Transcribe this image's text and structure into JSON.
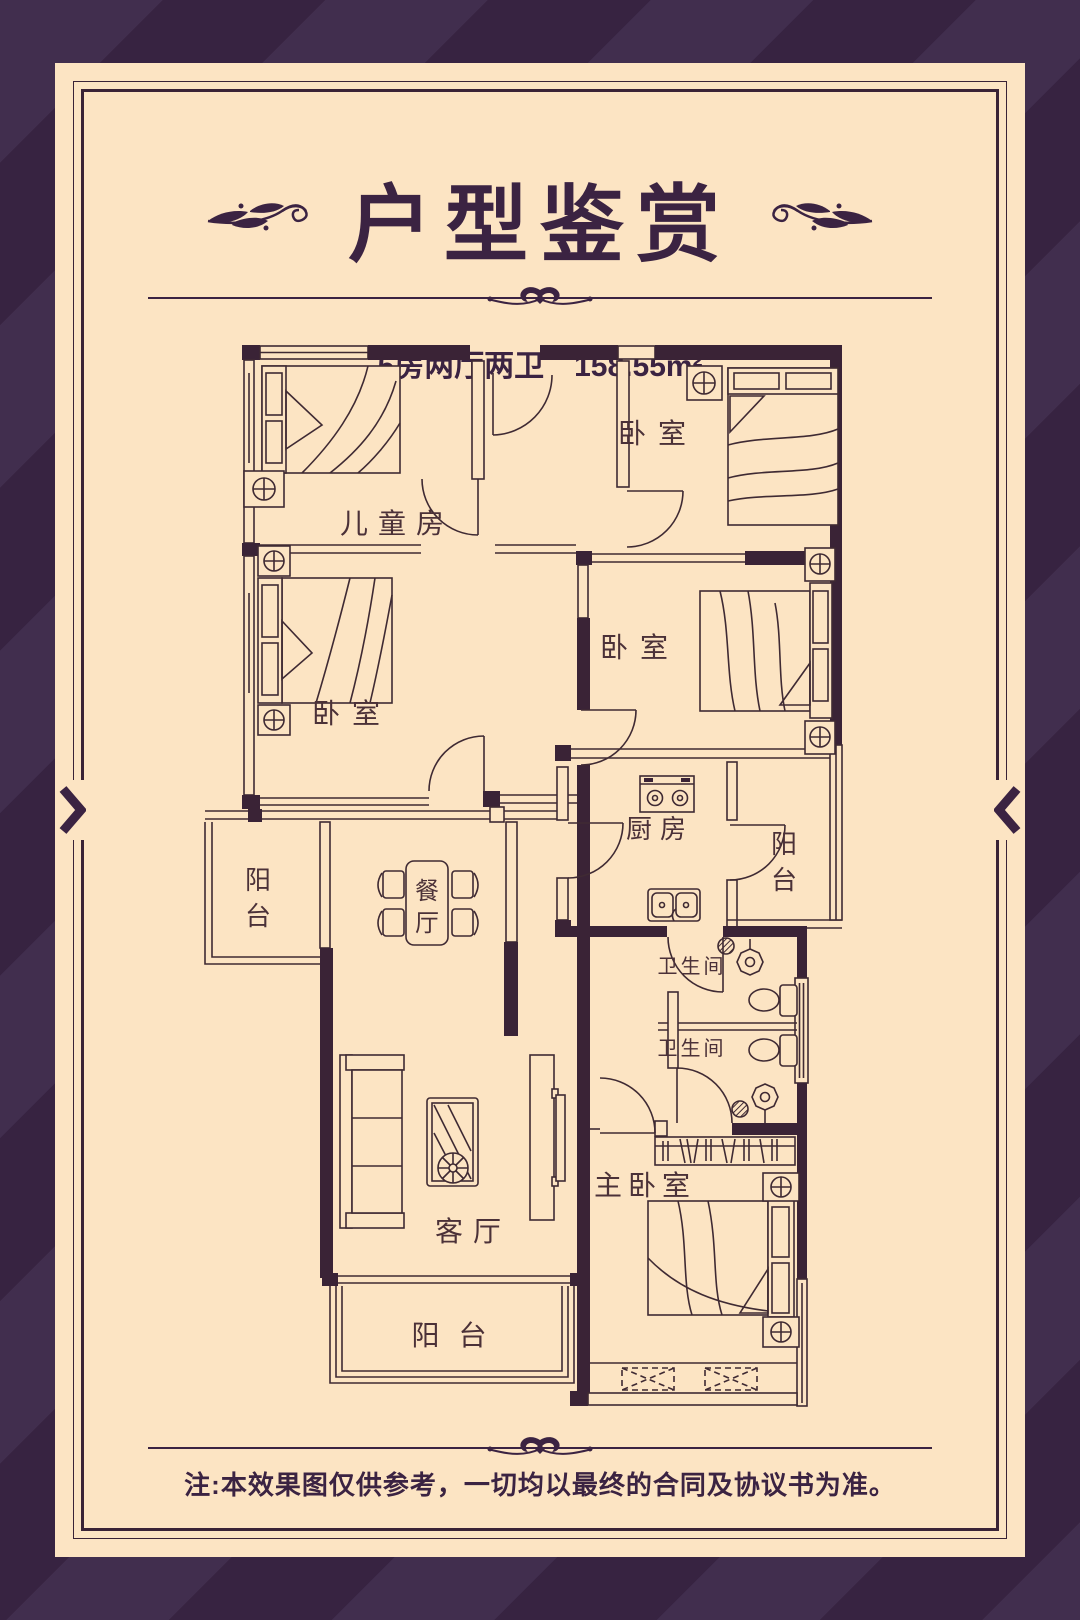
{
  "header": {
    "title": "户型鉴赏",
    "subtitle_type": "5房两厅两卫",
    "subtitle_area": "158.55m²"
  },
  "footer": {
    "note": "注:本效果图仅供参考，一切均以最终的合同及协议书为准。"
  },
  "colors": {
    "background_stripe_dark": "#372341",
    "background_stripe_light": "#412e4e",
    "card": "#fce4c3",
    "ink": "#3b2342",
    "plan_line": "#3f2a33"
  },
  "floorplan": {
    "children_room": "儿童房",
    "bedroom_top_right": "卧室",
    "bedroom_mid_left": "卧室",
    "bedroom_mid_right": "卧室",
    "master_bedroom": "主卧室",
    "living_room": "客厅",
    "kitchen": "厨房",
    "bathroom_1": "卫生间",
    "bathroom_2": "卫生间",
    "dining_chars": [
      "餐",
      "厅"
    ],
    "balcony_left_chars": [
      "阳",
      "台"
    ],
    "balcony_kitchen_chars": [
      "阳",
      "台"
    ],
    "balcony_bottom": "阳 台"
  }
}
